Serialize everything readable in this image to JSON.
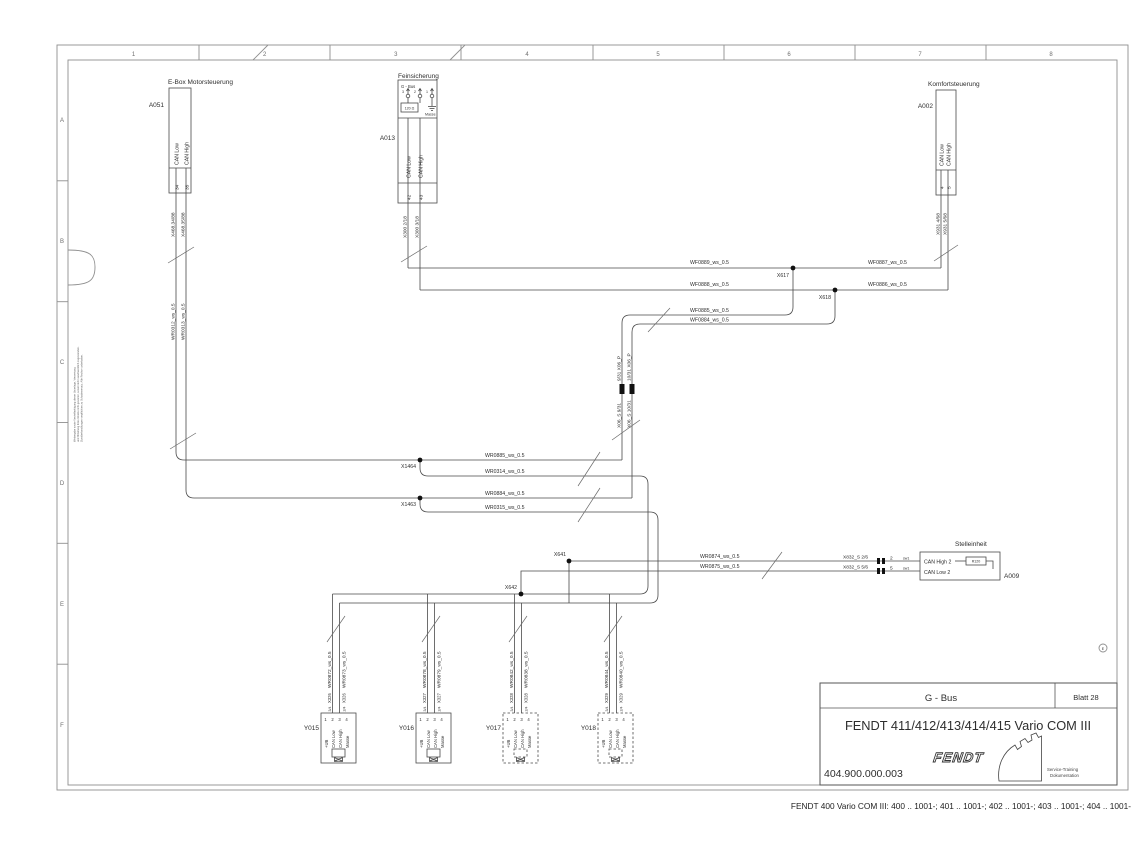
{
  "page": {
    "caption": "FENDT 400 Vario COM III: 400 .. 1001-; 401 .. 1001-; 402 .. 1001-; 403 .. 1001-; 404 .. 1001-"
  },
  "border": {
    "cols": [
      "1",
      "2",
      "3",
      "4",
      "5",
      "6",
      "7",
      "8"
    ],
    "rows": [
      "A",
      "B",
      "C",
      "D",
      "E",
      "F"
    ],
    "revision": "E"
  },
  "title_block": {
    "system": "G - Bus",
    "sheet": "Blatt 28",
    "title": "FENDT 411/412/413/414/415 Vario COM III",
    "doc_number": "404.900.000.003",
    "brand": "FENDT",
    "brand_sub1": "Service-Training",
    "brand_sub2": "Dokumentation"
  },
  "disclaimer": {
    "line1": "Weitergabe sowie Vervielfaeltigung dieser Unterlage, Verwertung",
    "line2": "und Mitteilung ihres Inhalts nicht gestattet, soweit nicht ausdruecklich zugestanden.",
    "line3": "Zuwiderhandlungen verpflichten zu Schadenersatz. Alle Rechte vorbehalten."
  },
  "a051": {
    "id": "A051",
    "title": "E-Box Motorsteuerung",
    "pin_labels": [
      "CAN Low",
      "CAN High"
    ],
    "pins": [
      "34",
      "35"
    ],
    "conns": [
      "X468.34/88",
      "X468.35/88"
    ],
    "wires": [
      "WR0312_ws_0.5",
      "WR0313_ws_0.5"
    ]
  },
  "a013": {
    "id": "A013",
    "title": "Feinsicherung",
    "header": "G - Bus",
    "terminals": [
      "3",
      "2",
      "1"
    ],
    "resistor": "120 Ω",
    "ground": "Masse",
    "pin_labels": [
      "CAN Low",
      "CAN High"
    ],
    "pins": [
      "42",
      "43"
    ],
    "conns": [
      "X300 2/18",
      "X300 3/18"
    ]
  },
  "a002": {
    "id": "A002",
    "title": "Komfortsteuerung",
    "pin_labels": [
      "CAN Low",
      "CAN High"
    ],
    "pins": [
      "4",
      "5"
    ],
    "conns": [
      "X931 4/68",
      "X931 5/68"
    ]
  },
  "a009": {
    "id": "A009",
    "title": "Stelleinheit",
    "resistor": "R120",
    "rows": [
      {
        "conn": "X832_S  2/6",
        "pin": "2",
        "tag": "sw1",
        "signal": "CAN High 2"
      },
      {
        "conn": "X832_S  5/6",
        "pin": "5",
        "tag": "sw1",
        "signal": "CAN Low 2"
      }
    ]
  },
  "junctions": {
    "x617": "X617",
    "x618": "X618",
    "x1464": "X1464",
    "x1463": "X1463",
    "x641": "X641",
    "x642": "X642"
  },
  "wire_labels": {
    "wf0889": "WF0889_ws_0.5",
    "wf0887": "WF0887_ws_0.5",
    "wf0888": "WF0888_ws_0.5",
    "wf0886": "WF0886_ws_0.5",
    "wf0885": "WF0885_ws_0.5",
    "wf0884": "WF0884_ws_0.5",
    "wr0885": "WR0885_ws_0.5",
    "wr0314": "WR0314_ws_0.5",
    "wr0884": "WR0884_ws_0.5",
    "wr0315": "WR0315_ws_0.5",
    "wr0874": "WR0874_ws_0.5",
    "wr0875": "WR0875_ws_0.5"
  },
  "bus_connectors": {
    "upper": [
      "9/31 X06_P",
      "10/31 X06_P"
    ],
    "lower": [
      "X06_S 9/31",
      "X06_S 10/31"
    ]
  },
  "valve_common": {
    "pins": [
      "1",
      "2",
      "3",
      "4"
    ],
    "pin_labels": [
      "+UB",
      "CAN Low",
      "CAN High",
      "Masse"
    ]
  },
  "valves": [
    {
      "id": "Y015",
      "wire_left": "WR0872_ws_0.5",
      "wire_right": "WR0873_ws_0.5",
      "conn": "X326",
      "conn_left": "3/4",
      "conn_right": "2/4"
    },
    {
      "id": "Y016",
      "wire_left": "WR0878_ws_0.5",
      "wire_right": "WR0879_ws_0.5",
      "conn": "X327",
      "conn_left": "3/4",
      "conn_right": "2/4"
    },
    {
      "id": "Y017",
      "wire_left": "WR0842_ws_0.5",
      "wire_right": "WR0838_ws_0.5",
      "conn": "X328",
      "conn_left": "3/4",
      "conn_right": "2/4"
    },
    {
      "id": "Y018",
      "wire_left": "WR0844_ws_0.5",
      "wire_right": "WR0840_ws_0.5",
      "conn": "X329",
      "conn_left": "3/4",
      "conn_right": "2/4"
    }
  ]
}
